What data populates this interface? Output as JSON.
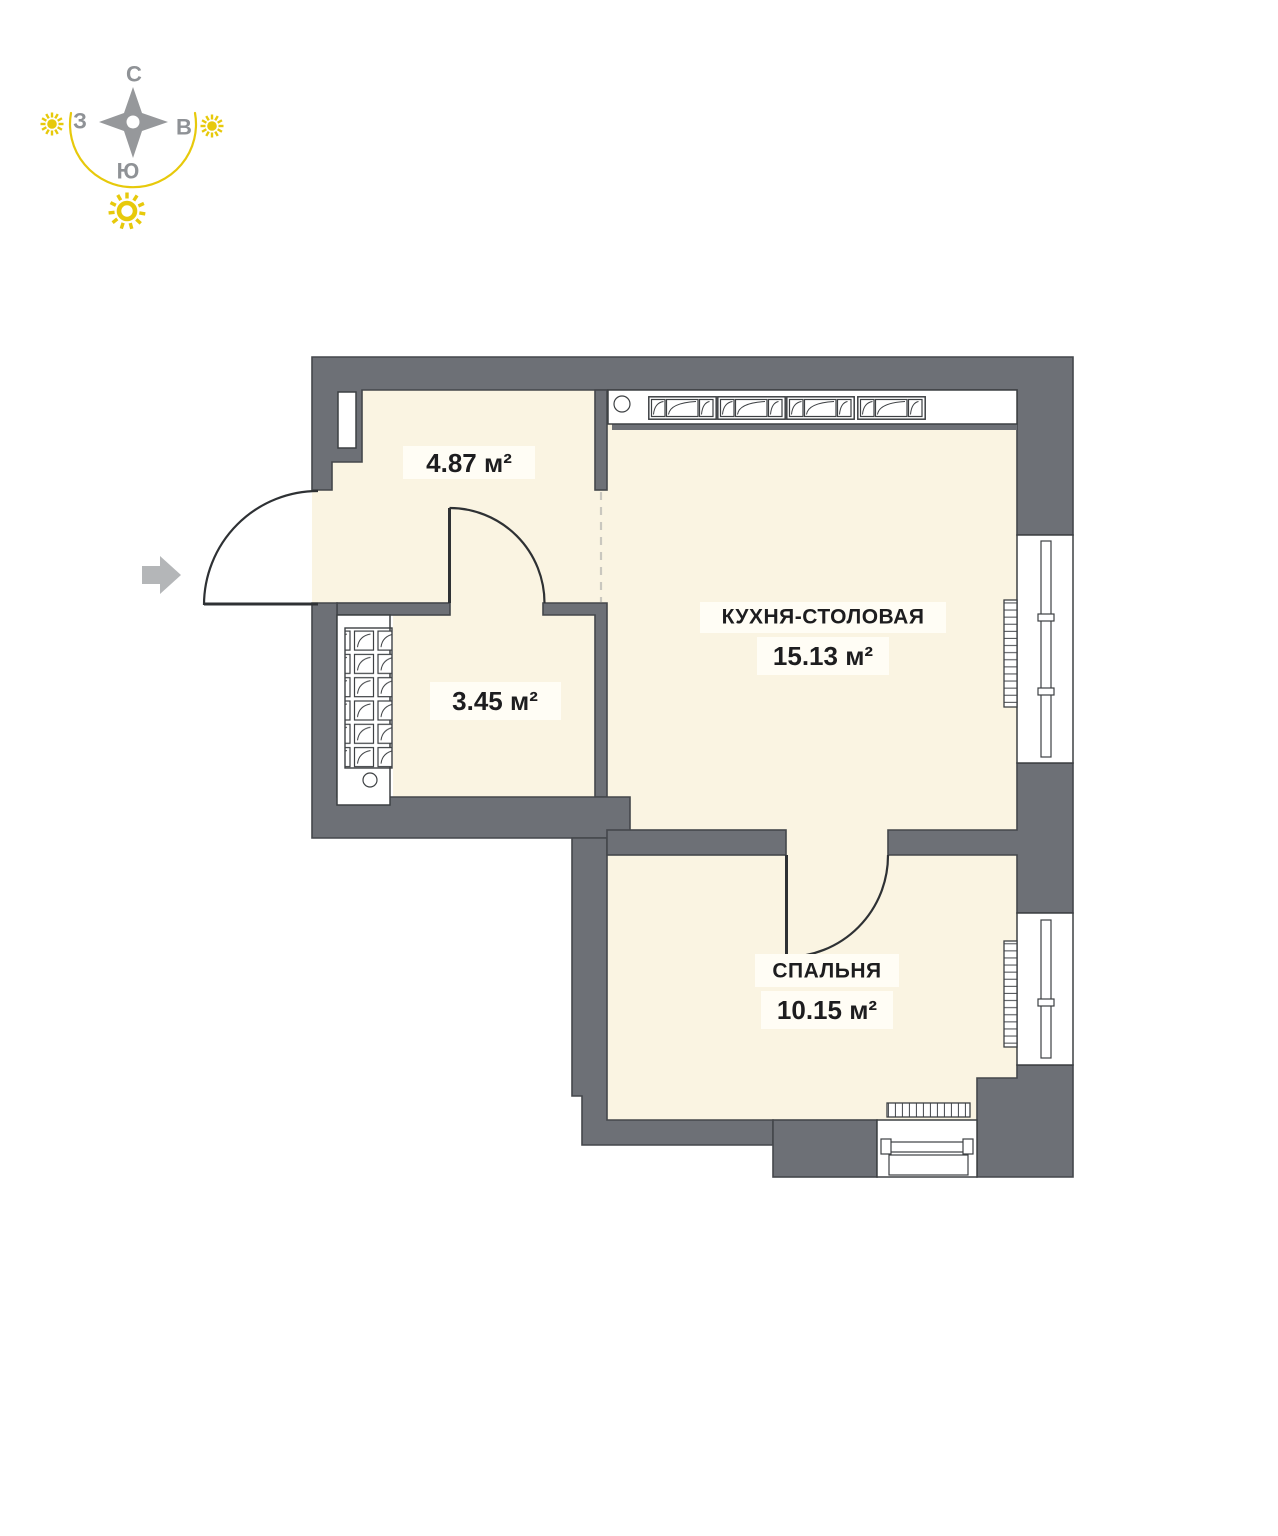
{
  "compass": {
    "letters": {
      "north": "С",
      "east": "В",
      "south": "Ю",
      "west": "З"
    }
  },
  "rooms": {
    "hallway": {
      "area": "4.87 м²"
    },
    "bathroom": {
      "area": "3.45 м²"
    },
    "kitchen": {
      "name": "КУХНЯ-СТОЛОВАЯ",
      "area": "15.13 м²"
    },
    "bedroom": {
      "name": "СПАЛЬНЯ",
      "area": "10.15 м²"
    }
  },
  "colors": {
    "wall": "#6d7076",
    "floor": "#faf4e2",
    "accent_yellow": "#e7c90b",
    "label_plate": "#fffdf5",
    "text": "#1d1d1f",
    "compass_gray": "#8f9296"
  }
}
